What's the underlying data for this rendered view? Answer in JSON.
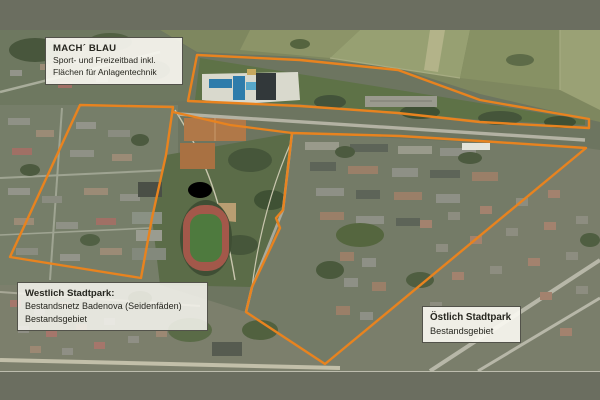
{
  "frame": {
    "band_color": "#6b6e60",
    "map_type": "satellite-aerial-photo"
  },
  "colors": {
    "boundary": "#e8831f",
    "label_background": "#f8f7f1",
    "label_border": "#52524a",
    "label_text": "#26261f"
  },
  "labels": {
    "mach_blau": {
      "title": "MACH´ BLAU",
      "line1": "Sport- und Freizeitbad inkl.",
      "line2": "Flächen für Anlagentechnik"
    },
    "west": {
      "title": "Westlich Stadtpark:",
      "line1": "Bestandsnetz Badenova (Seidenfäden)",
      "line2": "Bestandsgebiet"
    },
    "east": {
      "title": "Östlich Stadtpark",
      "line1": "Bestandsgebiet"
    }
  },
  "map": {
    "outlined_regions": [
      "Freizeitbad-Areal (Nord-Keil)",
      "Westlich Stadtpark",
      "Östlich Stadtpark"
    ],
    "landmarks": [
      "Schwimmbad / Freizeitbad",
      "Stadion mit Laufbahn",
      "Tennisplätze",
      "Stadtpark",
      "Wohngebiete",
      "Felder im Norden"
    ]
  }
}
